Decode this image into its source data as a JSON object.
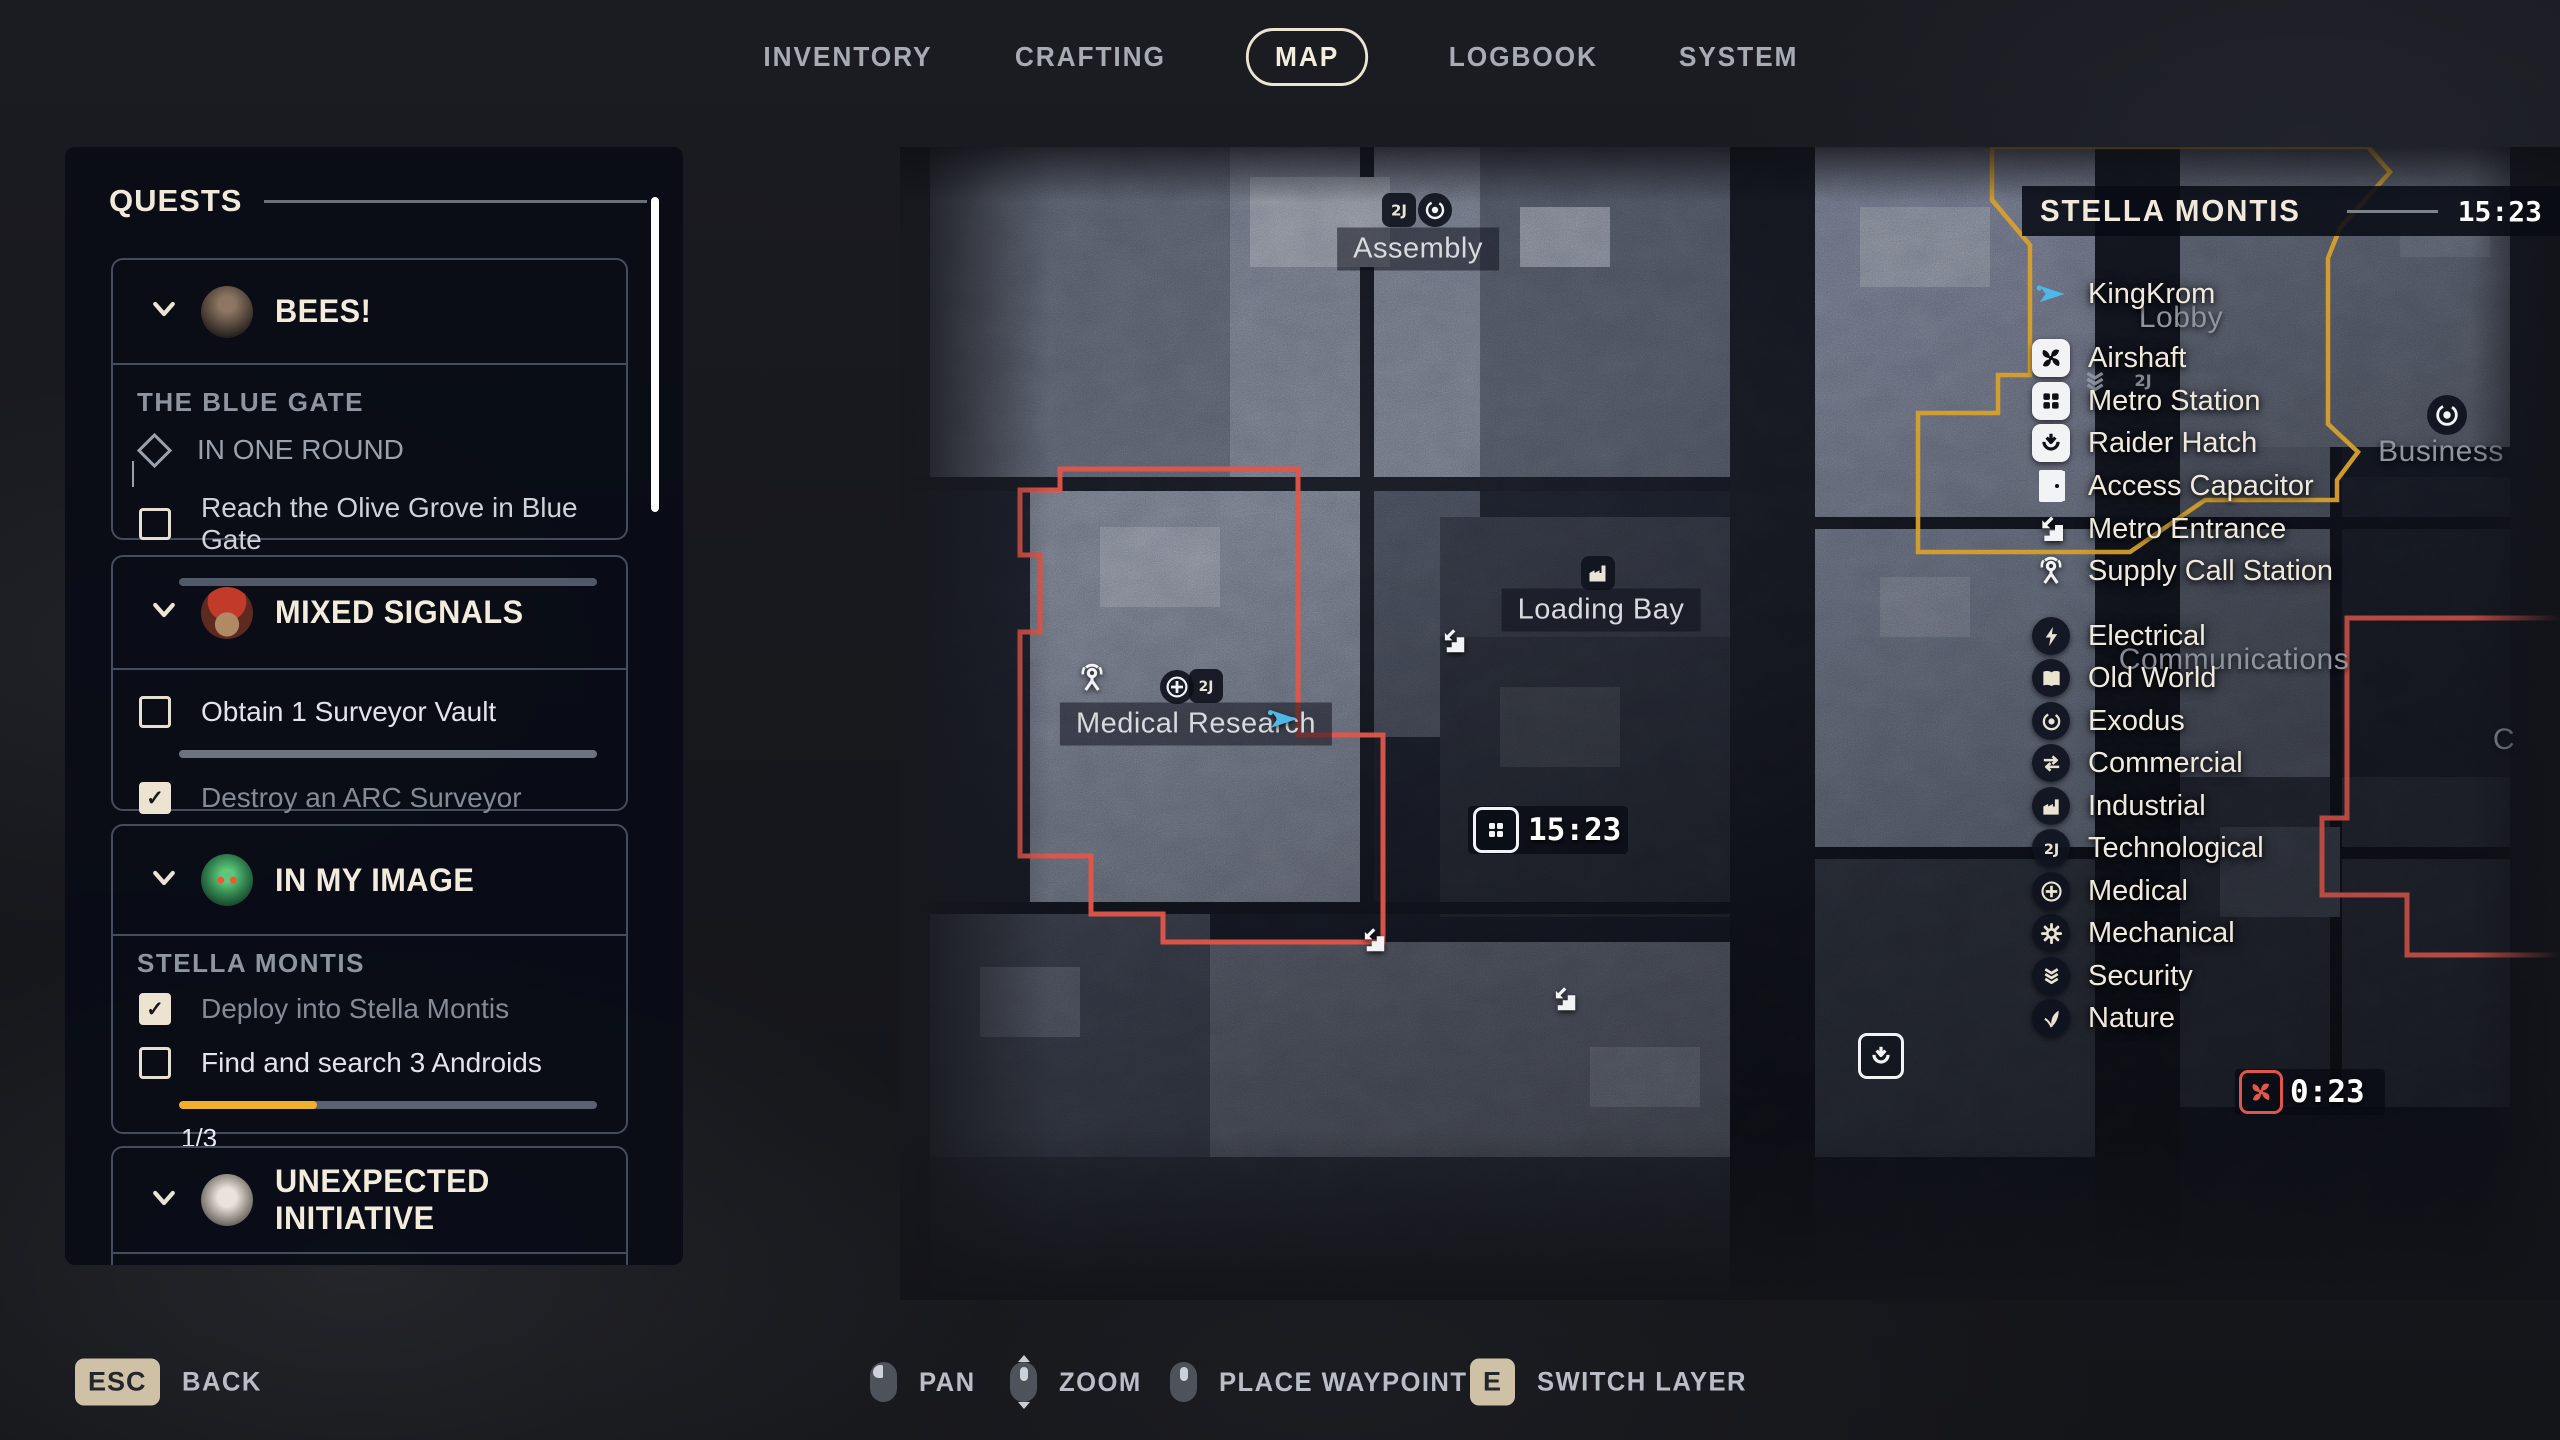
{
  "nav": {
    "items": [
      "INVENTORY",
      "CRAFTING",
      "MAP",
      "LOGBOOK",
      "SYSTEM"
    ],
    "active": "MAP"
  },
  "quests": {
    "title": "QUESTS",
    "cards": [
      {
        "title": "BEES!",
        "section": "THE BLUE GATE",
        "milestone": "IN ONE ROUND",
        "objectives": [
          {
            "label": "Reach the Olive Grove in Blue Gate",
            "checked": false
          }
        ]
      },
      {
        "title": "MIXED SIGNALS",
        "objectives": [
          {
            "label": "Obtain 1 Surveyor Vault",
            "checked": false
          },
          {
            "label": "Destroy an ARC Surveyor",
            "checked": true
          }
        ]
      },
      {
        "title": "IN MY IMAGE",
        "section": "STELLA MONTIS",
        "objectives": [
          {
            "label": "Deploy into Stella Montis",
            "checked": true
          },
          {
            "label": "Find and search 3 Androids",
            "checked": false
          }
        ],
        "progress": {
          "label": "1/3",
          "percent": 33
        }
      },
      {
        "title": "UNEXPECTED INITIATIVE"
      }
    ]
  },
  "map": {
    "labels": {
      "assembly": "Assembly",
      "loading_bay": "Loading Bay",
      "medical_research": "Medical Research",
      "lobby": "Lobby",
      "business": "Business",
      "communications": "Communications",
      "partial_right": "C"
    },
    "metro_time": "15:23",
    "airshaft_time": "0:23"
  },
  "legend": {
    "title": "STELLA MONTIS",
    "time": "15:23",
    "items": [
      {
        "icon": "player-arrow-icon",
        "label": "KingKrom"
      },
      {
        "icon": "airshaft-icon",
        "label": "Airshaft"
      },
      {
        "icon": "metro-station-icon",
        "label": "Metro Station"
      },
      {
        "icon": "raider-hatch-icon",
        "label": "Raider Hatch"
      },
      {
        "icon": "access-capacitor-icon",
        "label": "Access Capacitor"
      },
      {
        "icon": "metro-entrance-icon",
        "label": "Metro Entrance"
      },
      {
        "icon": "supply-call-station-icon",
        "label": "Supply Call Station"
      },
      {
        "icon": "electrical-icon",
        "label": "Electrical"
      },
      {
        "icon": "old-world-icon",
        "label": "Old World"
      },
      {
        "icon": "exodus-icon",
        "label": "Exodus"
      },
      {
        "icon": "commercial-icon",
        "label": "Commercial"
      },
      {
        "icon": "industrial-icon",
        "label": "Industrial"
      },
      {
        "icon": "technological-icon",
        "label": "Technological"
      },
      {
        "icon": "medical-icon",
        "label": "Medical"
      },
      {
        "icon": "mechanical-icon",
        "label": "Mechanical"
      },
      {
        "icon": "security-icon",
        "label": "Security"
      },
      {
        "icon": "nature-icon",
        "label": "Nature"
      }
    ]
  },
  "hints": [
    {
      "key": "ESC",
      "label": "BACK"
    },
    {
      "mouse": "left",
      "label": "PAN"
    },
    {
      "mouse": "wheel",
      "label": "ZOOM"
    },
    {
      "mouse": "middle",
      "label": "PLACE WAYPOINT"
    },
    {
      "key": "E",
      "label": "SWITCH LAYER"
    }
  ],
  "colors": {
    "accent_cream": "#ece3d0",
    "progress_yellow": "#f0b02a",
    "region_red": "#e25649",
    "region_yellow": "#d7a02c",
    "player_cyan": "#4cb9e8"
  }
}
